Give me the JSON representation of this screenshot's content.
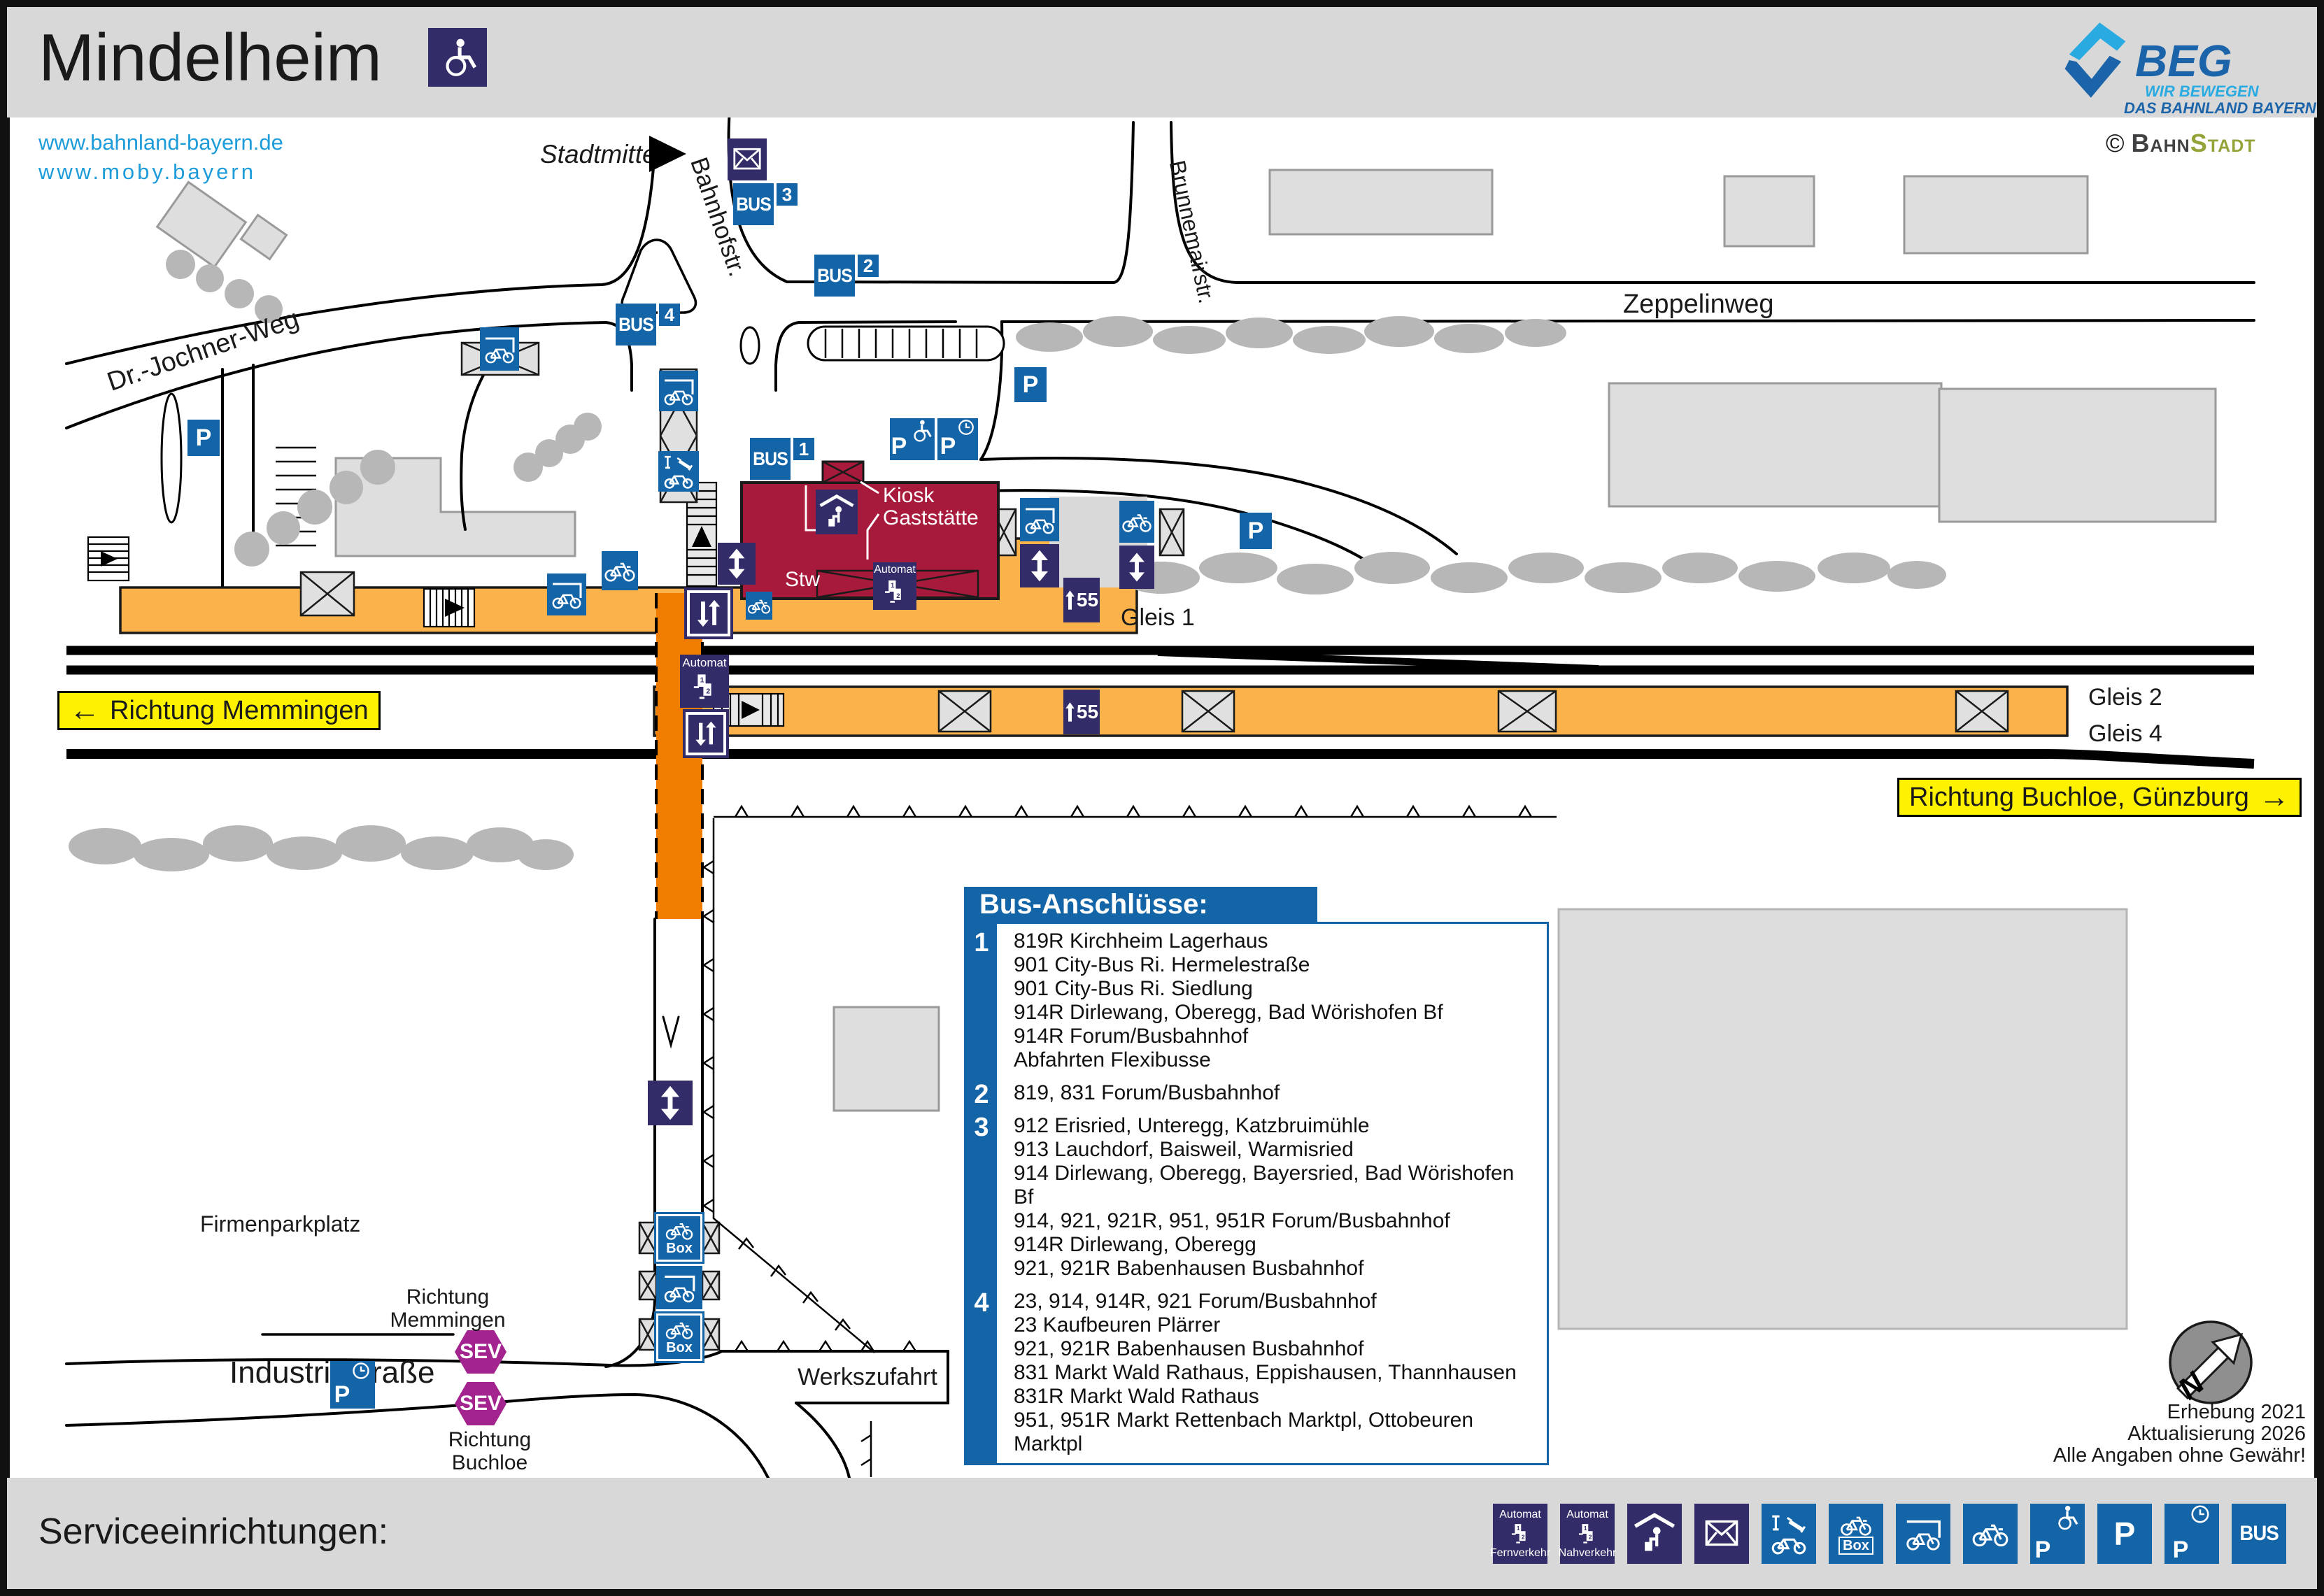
{
  "title": "Mindelheim",
  "links": {
    "l1": "www.bahnland-bayern.de",
    "l2": "www.moby.bayern"
  },
  "logo": {
    "beg": "BEG",
    "tag1": "WIR BEWEGEN",
    "tag2": "DAS BAHNLAND BAYERN",
    "credit_sym": "©",
    "credit_a": "Bahn",
    "credit_b": "Stadt"
  },
  "streets": {
    "stadtmitte": "Stadtmitte",
    "bahnhofstr": "Bahnhofstr.",
    "drjochner": "Dr.-Jochner-Weg",
    "zeppelinweg": "Zeppelinweg",
    "brunnemairstr": "Brunnemairstr.",
    "industriestr": "Industriestraße",
    "werkszufahrt": "Werkszufahrt",
    "firmenparkplatz": "Firmenparkplatz"
  },
  "rail": {
    "gleis1": "Gleis 1",
    "gleis2": "Gleis 2",
    "gleis4": "Gleis 4",
    "dir_west_arrow": "←",
    "dir_west": "Richtung Memmingen",
    "dir_east": "Richtung Buchloe, Günzburg",
    "dir_east_arrow": "→"
  },
  "road_dir": {
    "mem1": "Richtung",
    "mem2": "Memmingen",
    "buch1": "Richtung",
    "buch2": "Buchloe"
  },
  "signs": {
    "bus": "BUS",
    "p": "P",
    "sev": "SEV",
    "automat": "Automat",
    "box": "Box",
    "stop1": "1",
    "stop2": "2",
    "stop3": "3",
    "stop4": "4",
    "h55": "55"
  },
  "station": {
    "kiosk": "Kiosk",
    "gaststaette": "Gaststätte",
    "stw": "Stw"
  },
  "bus_panel": {
    "title": "Bus-Anschlüsse:",
    "groups": [
      {
        "stop": "1",
        "lines": [
          "819R Kirchheim Lagerhaus",
          "901 City-Bus Ri. Hermelestraße",
          "901 City-Bus Ri. Siedlung",
          "914R Dirlewang, Oberegg, Bad Wörishofen Bf",
          "914R Forum/Busbahnhof",
          "Abfahrten Flexibusse"
        ]
      },
      {
        "stop": "2",
        "lines": [
          "819, 831 Forum/Busbahnhof"
        ]
      },
      {
        "stop": "3",
        "lines": [
          "912 Erisried, Unteregg, Katzbruimühle",
          "913 Lauchdorf, Baisweil, Warmisried",
          "914 Dirlewang, Oberegg, Bayersried, Bad Wörishofen Bf",
          "914, 921, 921R, 951, 951R Forum/Busbahnhof",
          "914R Dirlewang, Oberegg",
          "921, 921R Babenhausen Busbahnhof"
        ]
      },
      {
        "stop": "4",
        "lines": [
          "23, 914, 914R, 921 Forum/Busbahnhof",
          "23 Kaufbeuren Plärrer",
          "921, 921R Babenhausen Busbahnhof",
          "831 Markt Wald Rathaus, Eppishausen, Thannhausen",
          "831R Markt Wald Rathaus",
          "951, 951R Markt Rettenbach Marktpl, Ottobeuren Marktpl"
        ]
      }
    ]
  },
  "notes": {
    "n1": "Erhebung 2021",
    "n2": "Aktualisierung 2026",
    "n3": "Alle Angaben ohne Gewähr!"
  },
  "north": {
    "n": "N"
  },
  "footer": {
    "title": "Serviceeinrichtungen:",
    "automat_top": "Automat",
    "fern": "Fernverkehr",
    "nah": "Nahverkehr"
  },
  "colors": {
    "accent_blue": "#1464a8",
    "navy": "#322d68",
    "platform_orange": "#fbb24a",
    "underpass_orange": "#f07d00",
    "building_red": "#a81a3b",
    "sign_yellow": "#fff200",
    "sev_purple": "#a3248f",
    "beg_lightblue": "#29abe2",
    "beg_blue": "#1c64a9",
    "link_blue": "#1e9cd9",
    "bahnstadt_green": "#95a338",
    "band_gray": "#d8d8d8",
    "building_gray": "#dedede",
    "tree_gray": "#b7b7b7"
  }
}
